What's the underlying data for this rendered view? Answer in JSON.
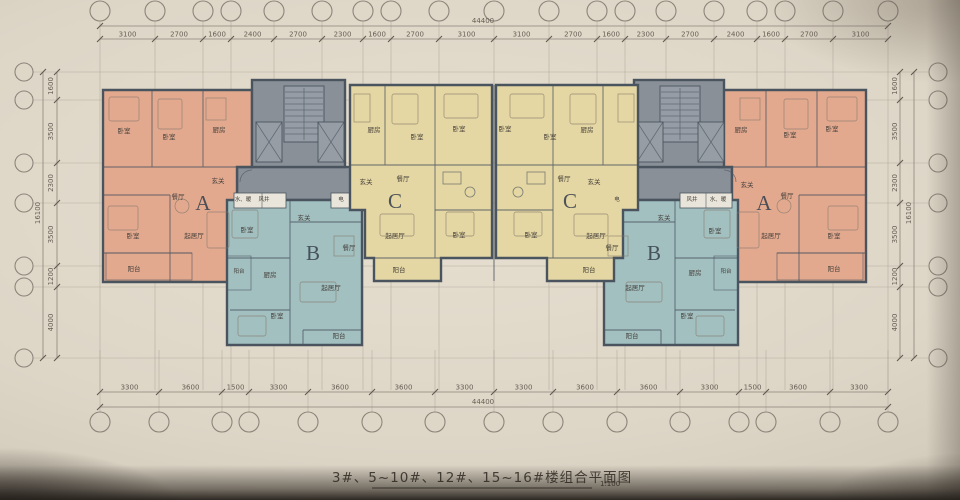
{
  "page": {
    "title": "3#、5~10#、12#、15~16#楼组合平面图",
    "scale": "1:100"
  },
  "dimensions": {
    "top": {
      "total": "44400",
      "segments": [
        "3100",
        "2700",
        "1600",
        "2400",
        "2700",
        "2300",
        "1600",
        "2700",
        "3100",
        "3100",
        "2700",
        "1600",
        "2300",
        "2700",
        "2400",
        "1600",
        "2700",
        "3100"
      ]
    },
    "bottom": {
      "total": "44400",
      "segments": [
        "3300",
        "3600",
        "1500",
        "3300",
        "3600",
        "3600",
        "3300",
        "3300",
        "3600",
        "3600",
        "3300",
        "1500",
        "3600",
        "3300"
      ]
    },
    "left": {
      "total": "16100",
      "segments": [
        "1600",
        "3500",
        "2300",
        "3500",
        "1200",
        "4000"
      ]
    },
    "right": {
      "total": "16100",
      "segments": [
        "1600",
        "3500",
        "2300",
        "3500",
        "1200",
        "4000"
      ]
    }
  },
  "labels": {
    "bedroom": "卧室",
    "kitchen": "厨房",
    "dining": "餐厅",
    "living": "起居厅",
    "balcony": "阳台",
    "entry": "玄关",
    "elec": "电",
    "water_heat": "水、暖",
    "air_shaft": "风井",
    "unit_a": "A",
    "unit_b": "B",
    "unit_c": "C"
  },
  "colors": {
    "paper": "#ddd5c6",
    "wall": "#4a545e",
    "unit_a": "#e3a98f",
    "unit_b": "#a3c0c1",
    "unit_c": "#e5d7a3",
    "core": "#8a9098",
    "shaft": "#e9e5da"
  }
}
